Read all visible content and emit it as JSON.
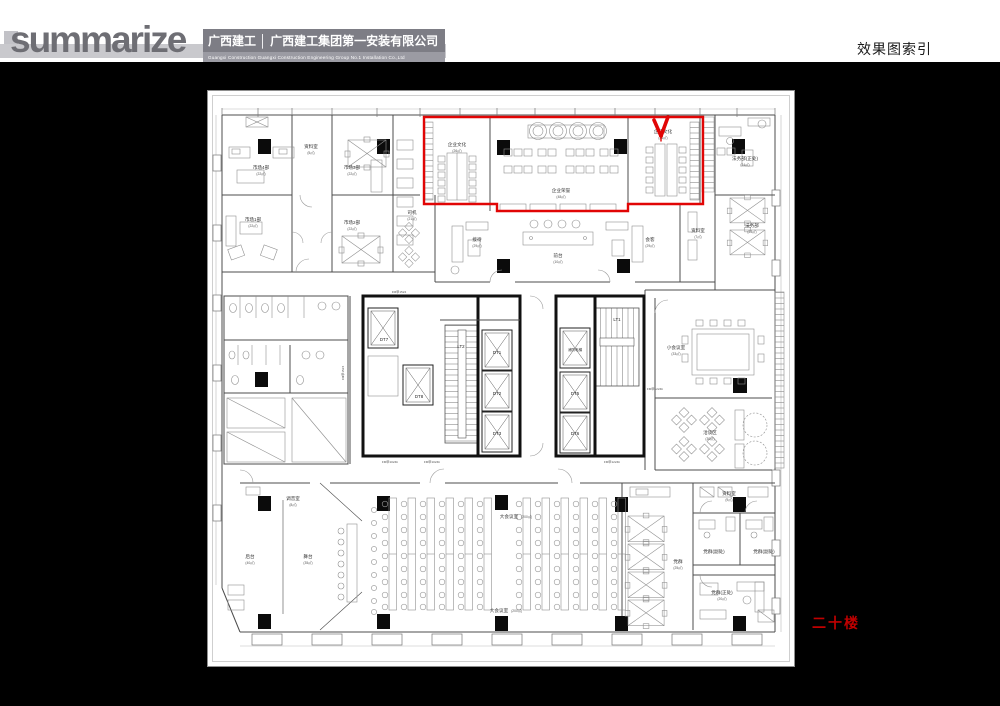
{
  "colors": {
    "highlight_red": "#e10505",
    "floor_text_red": "#c00000"
  },
  "header": {
    "logo_text": "summarize",
    "company_cn": "广西建工 │ 广西建工集团第一安装有限公司",
    "company_en": "Guangxi Construction        Guangxi Construction Engineering Group No.1 Installation Co.,Ltd",
    "page_title": "效果图索引"
  },
  "plan": {
    "floor_label": "二十楼",
    "rooms": [
      {
        "label": "市场4部",
        "area": "(22㎡)"
      },
      {
        "label": "市场3部",
        "area": "(22㎡)"
      },
      {
        "label": "资料室",
        "area": "(5㎡)"
      },
      {
        "label": "市场1部",
        "area": "(22㎡)"
      },
      {
        "label": "市场2部",
        "area": "(22㎡)"
      },
      {
        "label": "司机",
        "area": "(21㎡)"
      },
      {
        "label": "企业文化",
        "area": "(26㎡)"
      },
      {
        "label": "企业荣誉",
        "area": "(48㎡)"
      },
      {
        "label": "企业文化",
        "area": "(26㎡)"
      },
      {
        "label": "法务部(正处)",
        "area": "(24㎡)"
      },
      {
        "label": "法务部",
        "area": "(23㎡)"
      },
      {
        "label": "资料室",
        "area": "(7㎡)"
      },
      {
        "label": "接待",
        "area": "(29㎡)"
      },
      {
        "label": "前台",
        "area": "(10㎡)"
      },
      {
        "label": "会客",
        "area": "(29㎡)"
      },
      {
        "label": "小会议室",
        "area": "(33㎡)"
      },
      {
        "label": "洽谈区",
        "area": "(30㎡)"
      },
      {
        "label": "调音室",
        "area": "(8㎡)"
      },
      {
        "label": "后台",
        "area": "(40㎡)"
      },
      {
        "label": "舞台",
        "area": "(35㎡)"
      },
      {
        "label": "大会议室",
        "area": "(200㎡)"
      },
      {
        "label": "大会议室",
        "area": "(200㎡)"
      },
      {
        "label": "党群",
        "area": "(25㎡)"
      },
      {
        "label": "资料室",
        "area": "(9㎡)"
      },
      {
        "label": "党群(副处)",
        "area": "(12㎡)"
      },
      {
        "label": "党群(副处)",
        "area": "(12㎡)"
      },
      {
        "label": "党群(正处)",
        "area": "(20㎡)"
      }
    ],
    "core_labels": [
      "DT7",
      "DT8",
      "LT2",
      "DT1",
      "DT2",
      "DT3",
      "消防电梯",
      "DT5",
      "DT6",
      "LT1"
    ],
    "door_labels": [
      "FM甲1524",
      "FM甲1524",
      "FM甲1024b",
      "FM甲1024b",
      "FM甲1224b",
      "FM甲1224b"
    ]
  }
}
